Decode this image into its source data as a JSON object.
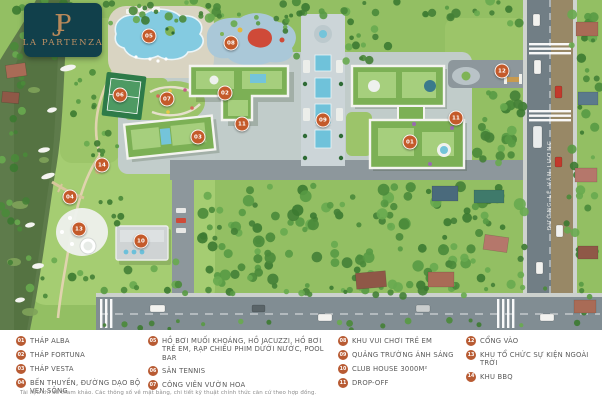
{
  "logo": {
    "monogram": "JP",
    "brand": "LA PARTENZA"
  },
  "map": {
    "street_label": "ĐƯỜNG LÊ VĂN LƯƠNG",
    "markers": [
      {
        "num": "05",
        "x": 149,
        "y": 36
      },
      {
        "num": "08",
        "x": 231,
        "y": 43
      },
      {
        "num": "06",
        "x": 120,
        "y": 95
      },
      {
        "num": "07",
        "x": 167,
        "y": 99
      },
      {
        "num": "02",
        "x": 225,
        "y": 93
      },
      {
        "num": "03",
        "x": 198,
        "y": 137
      },
      {
        "num": "09",
        "x": 323,
        "y": 120
      },
      {
        "num": "11",
        "x": 242,
        "y": 124
      },
      {
        "num": "11",
        "x": 456,
        "y": 118
      },
      {
        "num": "01",
        "x": 410,
        "y": 142
      },
      {
        "num": "12",
        "x": 502,
        "y": 71
      },
      {
        "num": "14",
        "x": 102,
        "y": 165
      },
      {
        "num": "04",
        "x": 70,
        "y": 197
      },
      {
        "num": "13",
        "x": 79,
        "y": 229
      },
      {
        "num": "10",
        "x": 141,
        "y": 241
      }
    ]
  },
  "legend": {
    "columns": [
      {
        "items": [
          {
            "num": "01",
            "label": "THÁP ALBA"
          },
          {
            "num": "02",
            "label": "THÁP FORTUNA"
          },
          {
            "num": "03",
            "label": "THÁP VESTA"
          },
          {
            "num": "04",
            "label": "BẾN THUYỀN, ĐƯỜNG DẠO BỘ VEN SÔNG"
          }
        ]
      },
      {
        "items": [
          {
            "num": "05",
            "label": "HỒ BƠI MUỐI KHOÁNG, HỒ JACUZZI, HỒ BƠI TRẺ EM, RẠP CHIẾU PHIM DƯỚI NƯỚC, POOL BAR"
          },
          {
            "num": "06",
            "label": "SÂN TENNIS"
          },
          {
            "num": "07",
            "label": "CÔNG VIÊN VƯỜN HOA"
          }
        ]
      },
      {
        "items": [
          {
            "num": "08",
            "label": "KHU VUI CHƠI TRẺ EM"
          },
          {
            "num": "09",
            "label": "QUẢNG TRƯỜNG ÁNH SÁNG"
          },
          {
            "num": "10",
            "label": "CLUB HOUSE 3000M²"
          },
          {
            "num": "11",
            "label": "DROP-OFF"
          }
        ]
      },
      {
        "items": [
          {
            "num": "12",
            "label": "CỔNG VÀO"
          },
          {
            "num": "13",
            "label": "KHU TỔ CHỨC SỰ KIỆN NGOÀI TRỜI"
          },
          {
            "num": "14",
            "label": "KHU BBQ"
          }
        ]
      }
    ],
    "disclaimer": "Tài liệu chỉ để tham khảo. Các thông số về mặt bằng, chi tiết kỹ thuật chính thức căn cứ theo hợp đồng."
  },
  "colors": {
    "marker": "#c45a2a",
    "legend_badge": "#b85b33",
    "logo_background": "#11404b",
    "logo_text": "#b9895a",
    "pool_water": "#84cbe1",
    "grass": "#93bf63"
  }
}
